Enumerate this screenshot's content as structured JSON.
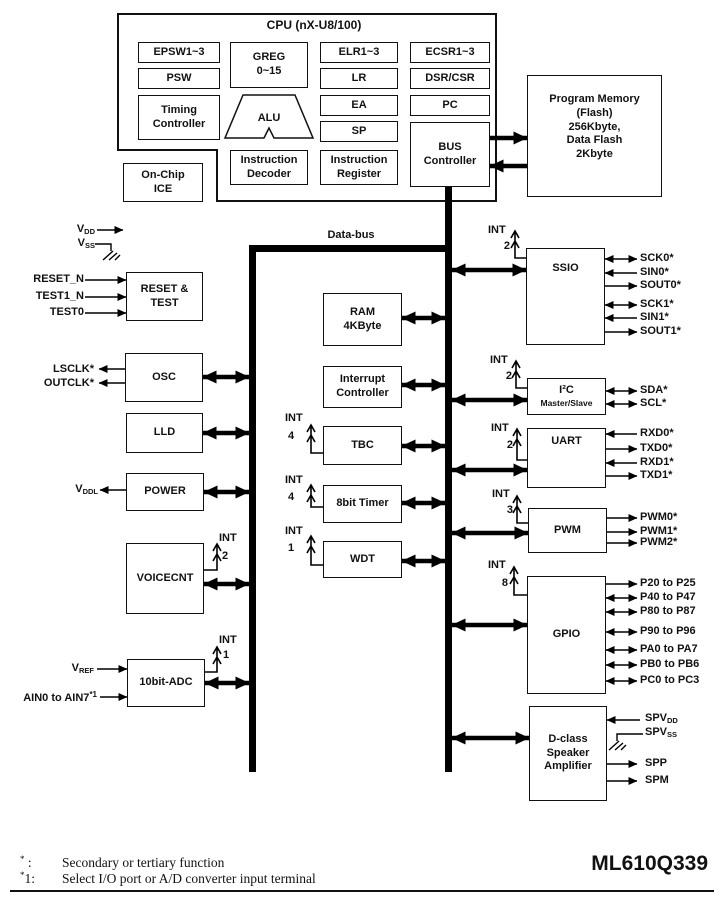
{
  "cpu": {
    "title": "CPU (nX-U8/100)",
    "epsw": "EPSW1~3",
    "psw": "PSW",
    "timing": "Timing\nController",
    "greg": "GREG\n0~15",
    "alu": "ALU",
    "idec": "Instruction\nDecoder",
    "elr": "ELR1~3",
    "lr": "LR",
    "ea": "EA",
    "sp": "SP",
    "ireg": "Instruction\nRegister",
    "ecsr": "ECSR1~3",
    "dsr": "DSR/CSR",
    "pc": "PC",
    "busctl": "BUS\nController",
    "ice": "On-Chip\nICE"
  },
  "memory": {
    "program": "Program Memory\n(Flash)\n256Kbyte,\nData Flash\n2Kbyte",
    "ram": "RAM\n4KByte"
  },
  "bus": {
    "label": "Data-bus"
  },
  "pins": {
    "vdd": {
      "base": "V",
      "sub": "DD"
    },
    "vss": {
      "base": "V",
      "sub": "SS"
    },
    "vddl": {
      "base": "V",
      "sub": "DDL"
    },
    "vref": {
      "base": "V",
      "sub": "REF"
    },
    "ain": {
      "base": "AIN0 to AIN7",
      "sup": "*1"
    },
    "spvdd": {
      "base": "SPV",
      "sub": "DD"
    },
    "spvss": {
      "base": "SPV",
      "sub": "SS"
    }
  },
  "blocks": {
    "reset": {
      "label": "RESET &\nTEST",
      "inputs": [
        "RESET_N",
        "TEST1_N",
        "TEST0"
      ]
    },
    "osc": {
      "label": "OSC",
      "outputs": [
        "LSCLK*",
        "OUTCLK*"
      ]
    },
    "lld": {
      "label": "LLD"
    },
    "power": {
      "label": "POWER"
    },
    "voicecnt": {
      "label": "VOICECNT",
      "int": "INT",
      "count": "2"
    },
    "adc": {
      "label": "10bit-ADC",
      "int": "INT",
      "count": "1"
    },
    "intctl": {
      "label": "Interrupt\nController"
    },
    "tbc": {
      "label": "TBC",
      "int": "INT",
      "count": "4"
    },
    "timer8": {
      "label": "8bit Timer",
      "int": "INT",
      "count": "4"
    },
    "wdt": {
      "label": "WDT",
      "int": "INT",
      "count": "1"
    },
    "ssio": {
      "label": "SSIO",
      "int": "INT",
      "count": "2",
      "signals": [
        "SCK0*",
        "SIN0*",
        "SOUT0*",
        "SCK1*",
        "SIN1*",
        "SOUT1*"
      ]
    },
    "i2c": {
      "label": "I²C",
      "sublabel": "Master/Slave",
      "int": "INT",
      "count": "2",
      "signals": [
        "SDA*",
        "SCL*"
      ]
    },
    "uart": {
      "label": "UART",
      "int": "INT",
      "count": "2",
      "signals": [
        "RXD0*",
        "TXD0*",
        "RXD1*",
        "TXD1*"
      ]
    },
    "pwm": {
      "label": "PWM",
      "int": "INT",
      "count": "3",
      "signals": [
        "PWM0*",
        "PWM1*",
        "PWM2*"
      ]
    },
    "gpio": {
      "label": "GPIO",
      "int": "INT",
      "count": "8",
      "signals": [
        "P20 to P25",
        "P40 to P47",
        "P80 to P87",
        "P90 to P96",
        "PA0 to PA7",
        "PB0 to PB6",
        "PC0 to PC3"
      ]
    },
    "dclass": {
      "label": "D-class\nSpeaker\nAmplifier",
      "signals": [
        "SPP",
        "SPM"
      ]
    }
  },
  "footer": {
    "notes": [
      {
        "star": "*",
        "num": "",
        "colon": ":",
        "text": "Secondary or tertiary function"
      },
      {
        "star": "*",
        "num": "1",
        "colon": ":",
        "text": "Select I/O port or A/D converter input terminal"
      }
    ],
    "part": "ML610Q339"
  }
}
